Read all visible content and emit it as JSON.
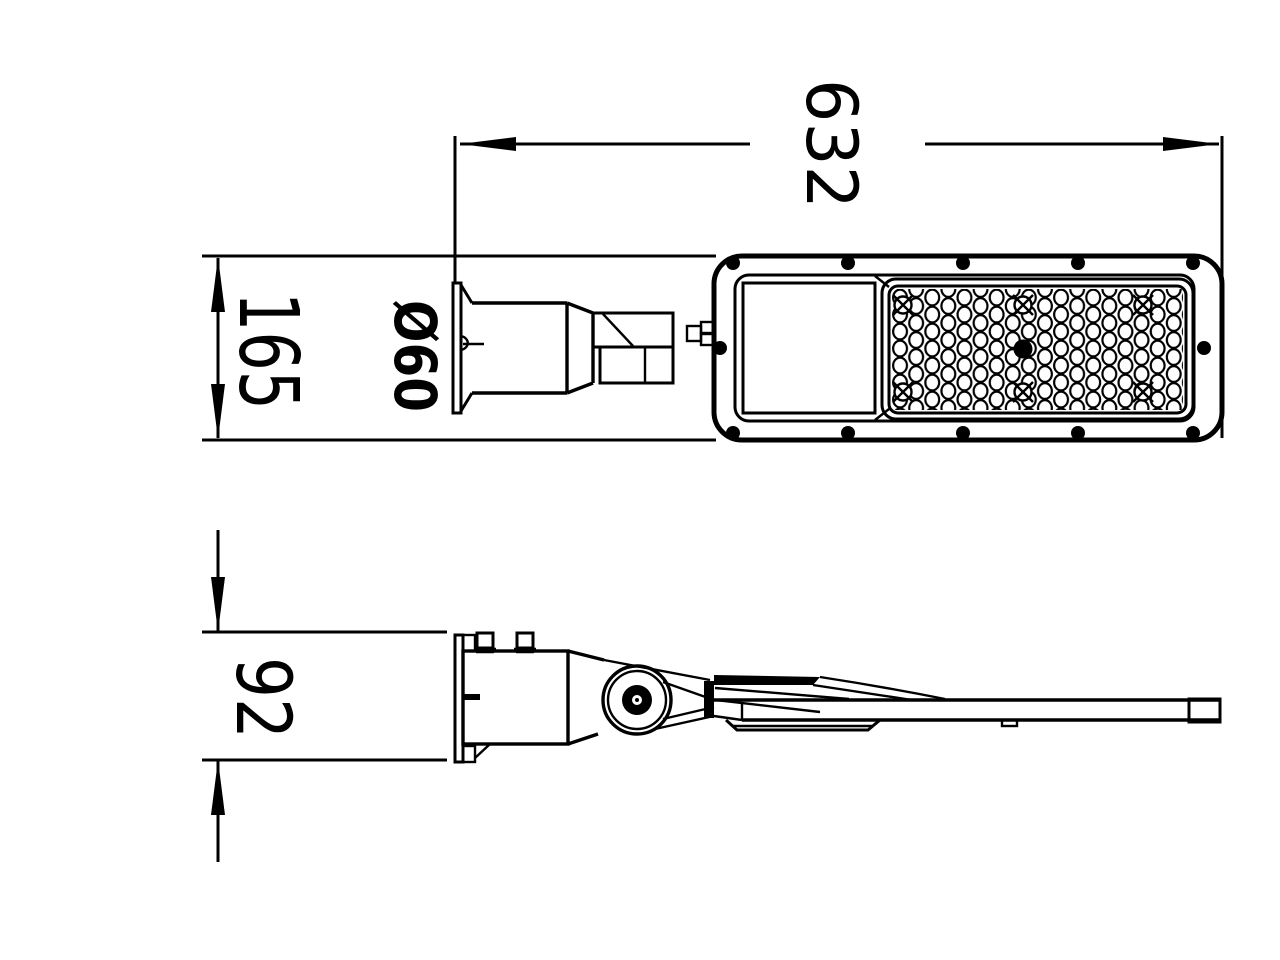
{
  "drawing": {
    "background_color": "#ffffff",
    "line_color": "#000000",
    "dimensions": {
      "overall_length": "632",
      "housing_width": "165",
      "pole_diameter": "Ø60",
      "mount_height": "92"
    }
  }
}
